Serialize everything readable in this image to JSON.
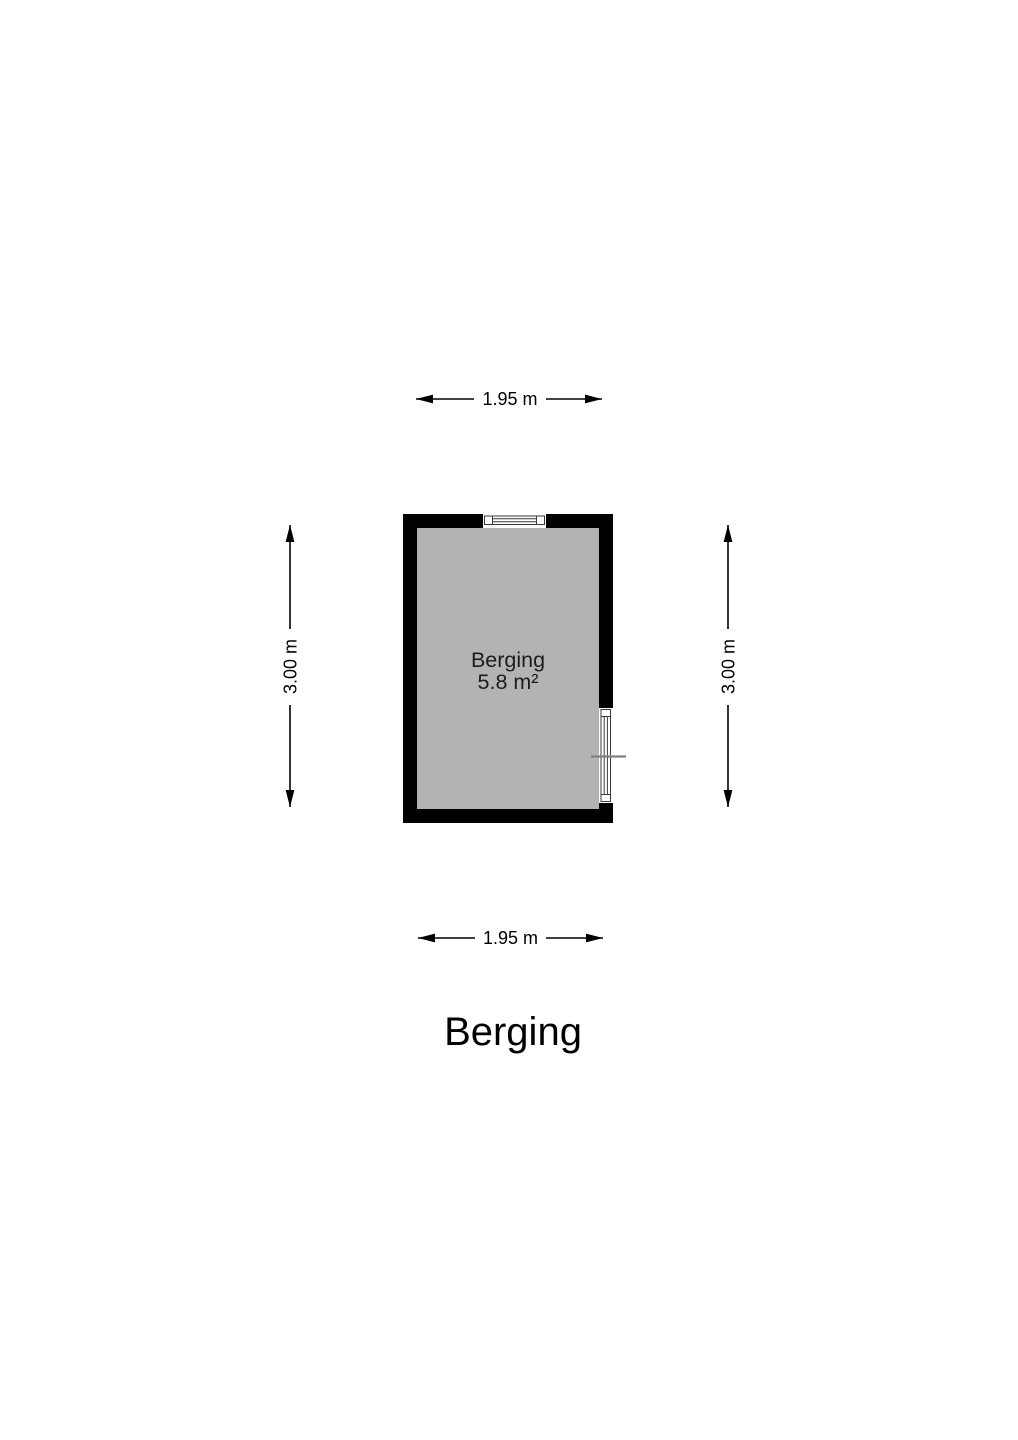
{
  "colors": {
    "background": "#ffffff",
    "wall": "#000000",
    "floor": "#b3b3b3",
    "dimension_line": "#000000",
    "door_tick": "#808080",
    "room_text": "#1c1c1c",
    "title_text": "#000000"
  },
  "floorplan": {
    "room": {
      "label": "Berging",
      "area": "5.8 m²"
    },
    "dimensions": {
      "top": "1.95 m",
      "bottom": "1.95 m",
      "left": "3.00 m",
      "right": "3.00 m"
    },
    "title": "Berging"
  }
}
